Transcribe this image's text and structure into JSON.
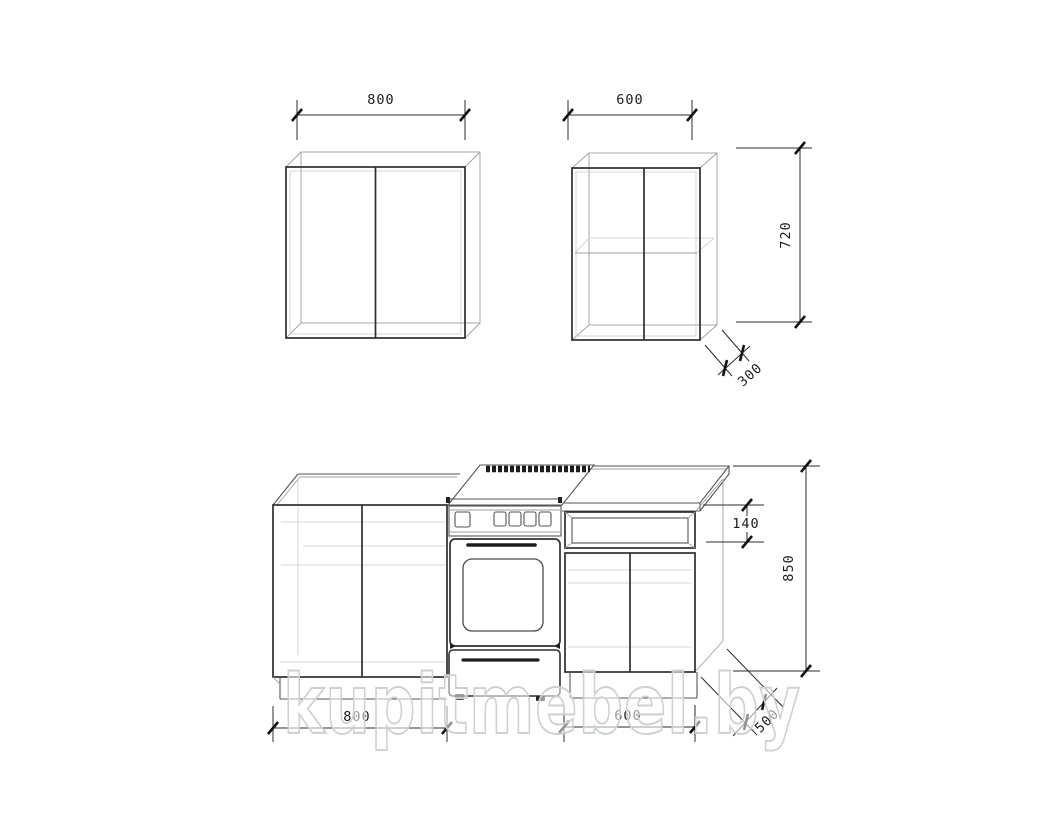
{
  "title": "Kitchen cabinets technical drawing",
  "watermark": {
    "text": "kupitmebel.by"
  },
  "dimensions": {
    "wall_left_width": "800",
    "wall_right_width": "600",
    "wall_height": "720",
    "wall_depth": "300",
    "worktop_apron_height": "140",
    "base_height": "850",
    "base_left_width": "800",
    "base_right_width": "600",
    "base_depth": "500"
  }
}
